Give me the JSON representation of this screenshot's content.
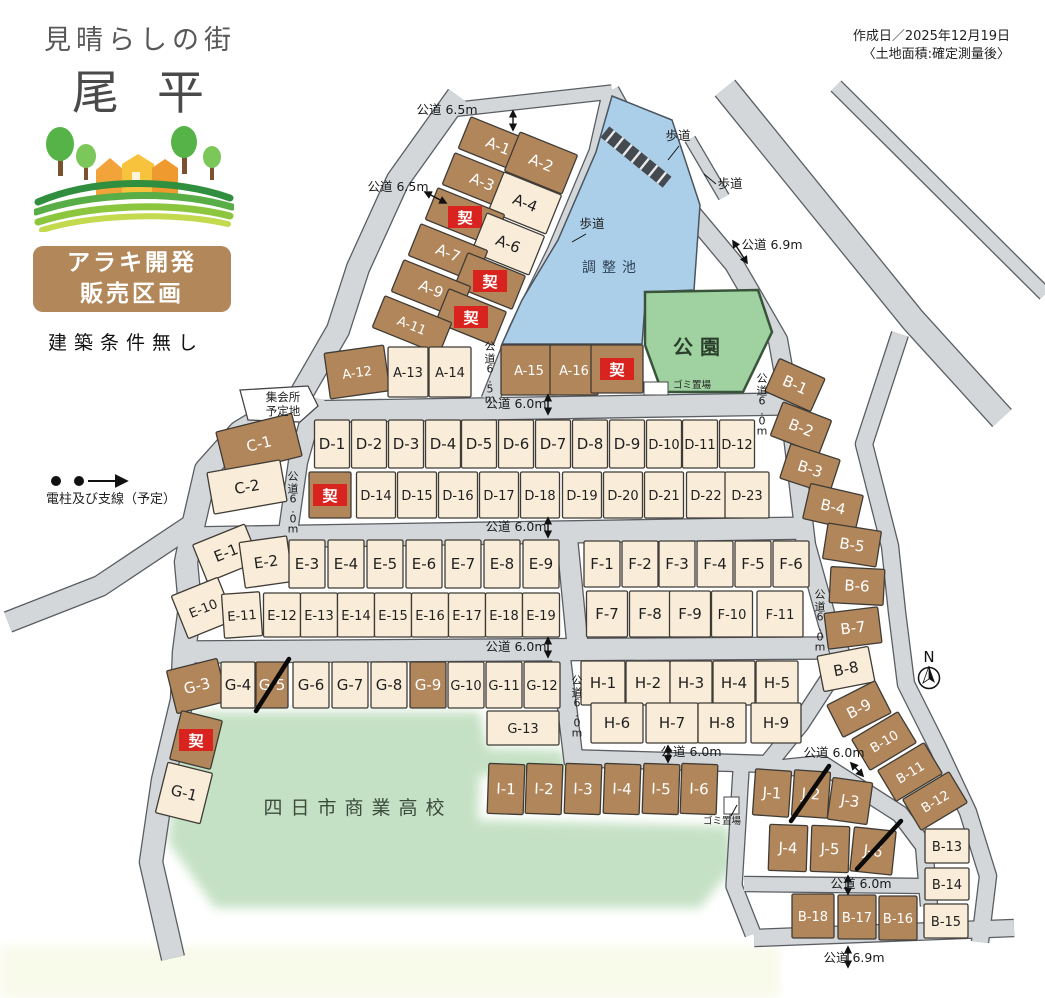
{
  "header": {
    "tagline": "見晴らしの街",
    "name": "尾平",
    "badge_line1": "アラキ開発",
    "badge_line2": "販売区画",
    "condition": "建築条件無し",
    "created": "作成日／2025年12月19日",
    "note": "〈土地面積:確定測量後〉"
  },
  "legend": {
    "utility_label": "電柱及び支線（予定）"
  },
  "compass": "N",
  "contract_mark": "契",
  "colors": {
    "brown": "#b2865b",
    "cream": "#f9ecd9",
    "road": "#d3d7da",
    "road_edge": "#5a5e63",
    "pond": "#accfe9",
    "park": "#9fd2a0",
    "school": "#c2e0c2",
    "red": "#d8231f",
    "outline": "#3f3b35",
    "text_dark": "#1f1f1f",
    "text_light": "#ffffff"
  },
  "areas": {
    "pond": "調整池",
    "park": "公園",
    "school": "四日市商業高校",
    "hall_line1": "集会所",
    "hall_line2": "予定地",
    "trash": "ゴミ置場"
  },
  "lots": [
    [
      "A-1",
      498,
      146,
      72,
      34,
      22,
      "b",
      ""
    ],
    [
      "A-2",
      541,
      163,
      62,
      42,
      22,
      "b",
      ""
    ],
    [
      "A-3",
      482,
      182,
      72,
      34,
      22,
      "b",
      ""
    ],
    [
      "A-4",
      525,
      203,
      62,
      42,
      22,
      "c",
      ""
    ],
    [
      "",
      465,
      217,
      72,
      34,
      22,
      "b",
      "k"
    ],
    [
      "A-6",
      508,
      244,
      62,
      42,
      22,
      "c",
      ""
    ],
    [
      "A-7",
      448,
      253,
      72,
      34,
      22,
      "b",
      ""
    ],
    [
      "",
      490,
      281,
      62,
      36,
      22,
      "b",
      "k"
    ],
    [
      "A-9",
      431,
      289,
      72,
      34,
      22,
      "b",
      ""
    ],
    [
      "",
      471,
      317,
      62,
      36,
      22,
      "b",
      "k"
    ],
    [
      "A-11",
      412,
      325,
      72,
      34,
      22,
      "b",
      ""
    ],
    [
      "A-12",
      357,
      372,
      60,
      46,
      -8,
      "b",
      ""
    ],
    [
      "A-13",
      408,
      372,
      40,
      50,
      0,
      "c",
      ""
    ],
    [
      "A-14",
      450,
      372,
      42,
      50,
      0,
      "c",
      ""
    ],
    [
      "A-15",
      529,
      370,
      56,
      50,
      0,
      "b",
      ""
    ],
    [
      "A-16",
      574,
      370,
      48,
      50,
      0,
      "b",
      ""
    ],
    [
      "",
      617,
      369,
      52,
      48,
      0,
      "b",
      "k"
    ],
    [
      "C-1",
      259,
      444,
      78,
      44,
      -14,
      "b",
      ""
    ],
    [
      "C-2",
      247,
      487,
      74,
      42,
      -10,
      "c",
      ""
    ],
    [
      "D-1",
      332,
      444,
      35,
      48,
      0,
      "c",
      ""
    ],
    [
      "D-2",
      369,
      444,
      35,
      48,
      0,
      "c",
      ""
    ],
    [
      "D-3",
      406,
      444,
      35,
      48,
      0,
      "c",
      ""
    ],
    [
      "D-4",
      443,
      444,
      35,
      48,
      0,
      "c",
      ""
    ],
    [
      "D-5",
      479,
      444,
      35,
      48,
      0,
      "c",
      ""
    ],
    [
      "D-6",
      516,
      444,
      35,
      48,
      0,
      "c",
      ""
    ],
    [
      "D-7",
      553,
      444,
      35,
      48,
      0,
      "c",
      ""
    ],
    [
      "D-8",
      590,
      444,
      35,
      48,
      0,
      "c",
      ""
    ],
    [
      "D-9",
      627,
      444,
      35,
      48,
      0,
      "c",
      ""
    ],
    [
      "D-10",
      664,
      444,
      35,
      48,
      0,
      "c",
      ""
    ],
    [
      "D-11",
      700,
      444,
      35,
      48,
      0,
      "c",
      ""
    ],
    [
      "D-12",
      737,
      444,
      35,
      48,
      0,
      "c",
      ""
    ],
    [
      "",
      330,
      495,
      42,
      46,
      0,
      "b",
      "k"
    ],
    [
      "D-14",
      376,
      495,
      39,
      46,
      0,
      "c",
      ""
    ],
    [
      "D-15",
      417,
      495,
      39,
      46,
      0,
      "c",
      ""
    ],
    [
      "D-16",
      458,
      495,
      39,
      46,
      0,
      "c",
      ""
    ],
    [
      "D-17",
      499,
      495,
      39,
      46,
      0,
      "c",
      ""
    ],
    [
      "D-18",
      540,
      495,
      39,
      46,
      0,
      "c",
      ""
    ],
    [
      "D-19",
      582,
      495,
      39,
      46,
      0,
      "c",
      ""
    ],
    [
      "D-20",
      623,
      495,
      39,
      46,
      0,
      "c",
      ""
    ],
    [
      "D-21",
      664,
      495,
      39,
      46,
      0,
      "c",
      ""
    ],
    [
      "D-22",
      706,
      495,
      39,
      46,
      0,
      "c",
      ""
    ],
    [
      "D-23",
      747,
      495,
      44,
      46,
      0,
      "c",
      ""
    ],
    [
      "E-1",
      226,
      553,
      56,
      40,
      -22,
      "c",
      ""
    ],
    [
      "E-2",
      266,
      562,
      48,
      46,
      -8,
      "c",
      ""
    ],
    [
      "E-3",
      307,
      564,
      36,
      48,
      0,
      "c",
      ""
    ],
    [
      "E-4",
      346,
      564,
      36,
      48,
      0,
      "c",
      ""
    ],
    [
      "E-5",
      385,
      564,
      36,
      48,
      0,
      "c",
      ""
    ],
    [
      "E-6",
      424,
      564,
      36,
      48,
      0,
      "c",
      ""
    ],
    [
      "E-7",
      463,
      564,
      36,
      48,
      0,
      "c",
      ""
    ],
    [
      "E-8",
      502,
      564,
      36,
      48,
      0,
      "c",
      ""
    ],
    [
      "E-9",
      541,
      564,
      36,
      48,
      0,
      "c",
      ""
    ],
    [
      "E-10",
      203,
      608,
      50,
      46,
      -22,
      "c",
      ""
    ],
    [
      "E-11",
      242,
      615,
      38,
      44,
      -4,
      "c",
      ""
    ],
    [
      "E-12",
      282,
      615,
      37,
      44,
      0,
      "c",
      ""
    ],
    [
      "E-13",
      319,
      615,
      37,
      44,
      0,
      "c",
      ""
    ],
    [
      "E-14",
      356,
      615,
      37,
      44,
      0,
      "c",
      ""
    ],
    [
      "E-15",
      393,
      615,
      37,
      44,
      0,
      "c",
      ""
    ],
    [
      "E-16",
      430,
      615,
      37,
      44,
      0,
      "c",
      ""
    ],
    [
      "E-17",
      467,
      615,
      37,
      44,
      0,
      "c",
      ""
    ],
    [
      "E-18",
      504,
      615,
      37,
      44,
      0,
      "c",
      ""
    ],
    [
      "E-19",
      541,
      615,
      37,
      44,
      0,
      "c",
      ""
    ],
    [
      "F-1",
      602,
      564,
      36,
      46,
      0,
      "c",
      ""
    ],
    [
      "F-2",
      640,
      564,
      36,
      46,
      0,
      "c",
      ""
    ],
    [
      "F-3",
      677,
      564,
      36,
      46,
      0,
      "c",
      ""
    ],
    [
      "F-4",
      715,
      564,
      36,
      46,
      0,
      "c",
      ""
    ],
    [
      "F-5",
      753,
      564,
      36,
      46,
      0,
      "c",
      ""
    ],
    [
      "F-6",
      791,
      564,
      36,
      46,
      0,
      "c",
      ""
    ],
    [
      "F-7",
      607,
      614,
      41,
      46,
      0,
      "c",
      ""
    ],
    [
      "F-8",
      650,
      614,
      41,
      46,
      0,
      "c",
      ""
    ],
    [
      "F-9",
      690,
      614,
      41,
      46,
      0,
      "c",
      ""
    ],
    [
      "F-10",
      732,
      614,
      41,
      46,
      0,
      "c",
      ""
    ],
    [
      "F-11",
      780,
      614,
      46,
      46,
      0,
      "c",
      ""
    ],
    [
      "G-3",
      197,
      686,
      52,
      44,
      -14,
      "b",
      ""
    ],
    [
      "G-4",
      238,
      685,
      34,
      46,
      0,
      "c",
      ""
    ],
    [
      "G-5",
      272,
      685,
      32,
      46,
      0,
      "b",
      "s"
    ],
    [
      "G-6",
      311,
      685,
      36,
      46,
      0,
      "c",
      ""
    ],
    [
      "G-7",
      350,
      685,
      36,
      46,
      0,
      "c",
      ""
    ],
    [
      "G-8",
      389,
      685,
      36,
      46,
      0,
      "c",
      ""
    ],
    [
      "G-9",
      428,
      685,
      36,
      46,
      0,
      "b",
      ""
    ],
    [
      "G-10",
      466,
      685,
      36,
      46,
      0,
      "c",
      ""
    ],
    [
      "G-11",
      504,
      685,
      36,
      46,
      0,
      "c",
      ""
    ],
    [
      "G-12",
      542,
      685,
      36,
      46,
      0,
      "c",
      ""
    ],
    [
      "G-13",
      523,
      728,
      72,
      34,
      0,
      "c",
      ""
    ],
    [
      "",
      196,
      740,
      42,
      50,
      14,
      "b",
      "k"
    ],
    [
      "G-1",
      184,
      793,
      46,
      52,
      14,
      "c",
      ""
    ],
    [
      "H-1",
      603,
      683,
      44,
      44,
      0,
      "c",
      ""
    ],
    [
      "H-2",
      648,
      683,
      44,
      44,
      0,
      "c",
      ""
    ],
    [
      "H-3",
      691,
      683,
      42,
      44,
      0,
      "c",
      ""
    ],
    [
      "H-4",
      734,
      683,
      42,
      44,
      0,
      "c",
      ""
    ],
    [
      "H-5",
      777,
      683,
      42,
      44,
      0,
      "c",
      ""
    ],
    [
      "H-6",
      617,
      723,
      52,
      40,
      0,
      "c",
      ""
    ],
    [
      "H-7",
      672,
      723,
      52,
      40,
      0,
      "c",
      ""
    ],
    [
      "H-8",
      722,
      723,
      48,
      40,
      0,
      "c",
      ""
    ],
    [
      "H-9",
      776,
      723,
      50,
      40,
      0,
      "c",
      ""
    ],
    [
      "I-1",
      506,
      789,
      36,
      50,
      2,
      "b",
      ""
    ],
    [
      "I-2",
      544,
      789,
      36,
      50,
      2,
      "b",
      ""
    ],
    [
      "I-3",
      583,
      789,
      36,
      50,
      2,
      "b",
      ""
    ],
    [
      "I-4",
      622,
      789,
      36,
      50,
      2,
      "b",
      ""
    ],
    [
      "I-5",
      661,
      789,
      36,
      50,
      2,
      "b",
      ""
    ],
    [
      "I-6",
      699,
      789,
      36,
      50,
      2,
      "b",
      ""
    ],
    [
      "J-1",
      772,
      793,
      36,
      46,
      4,
      "b",
      ""
    ],
    [
      "J-2",
      811,
      794,
      36,
      46,
      4,
      "b",
      "s"
    ],
    [
      "J-3",
      850,
      801,
      40,
      42,
      8,
      "b",
      ""
    ],
    [
      "J-4",
      788,
      848,
      38,
      46,
      2,
      "b",
      ""
    ],
    [
      "J-5",
      830,
      849,
      38,
      46,
      2,
      "b",
      ""
    ],
    [
      "J-6",
      873,
      851,
      42,
      44,
      6,
      "b",
      "s"
    ],
    [
      "B-1",
      795,
      385,
      50,
      36,
      24,
      "b",
      ""
    ],
    [
      "B-2",
      801,
      428,
      52,
      36,
      21,
      "b",
      ""
    ],
    [
      "B-3",
      810,
      469,
      52,
      36,
      18,
      "b",
      ""
    ],
    [
      "B-4",
      833,
      507,
      54,
      36,
      13,
      "b",
      ""
    ],
    [
      "B-5",
      852,
      545,
      54,
      36,
      9,
      "b",
      ""
    ],
    [
      "B-6",
      857,
      586,
      54,
      36,
      3,
      "b",
      ""
    ],
    [
      "B-7",
      853,
      628,
      54,
      36,
      -7,
      "b",
      ""
    ],
    [
      "B-8",
      846,
      669,
      52,
      36,
      -11,
      "c",
      ""
    ],
    [
      "B-9",
      859,
      709,
      54,
      36,
      -27,
      "b",
      ""
    ],
    [
      "B-10",
      884,
      741,
      54,
      36,
      -31,
      "b",
      ""
    ],
    [
      "B-11",
      910,
      772,
      54,
      36,
      -31,
      "b",
      ""
    ],
    [
      "B-12",
      935,
      801,
      54,
      36,
      -31,
      "b",
      ""
    ],
    [
      "B-13",
      947,
      846,
      44,
      34,
      0,
      "c",
      ""
    ],
    [
      "B-14",
      947,
      884,
      44,
      32,
      0,
      "c",
      ""
    ],
    [
      "B-15",
      946,
      921,
      44,
      34,
      0,
      "c",
      ""
    ],
    [
      "B-16",
      898,
      918,
      38,
      44,
      0,
      "b",
      ""
    ],
    [
      "B-17",
      857,
      917,
      38,
      44,
      0,
      "b",
      ""
    ],
    [
      "B-18",
      813,
      916,
      42,
      44,
      0,
      "b",
      ""
    ]
  ],
  "road_labels": [
    [
      "公道 6.5m",
      447,
      114,
      0
    ],
    [
      "公道 6.5m",
      398,
      191,
      0
    ],
    [
      "歩道",
      678,
      140,
      0
    ],
    [
      "歩道",
      730,
      188,
      0
    ],
    [
      "歩道",
      592,
      228,
      0
    ],
    [
      "公道 6.9m",
      772,
      249,
      0
    ],
    [
      "公道6.5m",
      490,
      350,
      1
    ],
    [
      "公道 6.0m",
      516,
      408,
      0
    ],
    [
      "公道6.0m",
      762,
      382,
      1
    ],
    [
      "公道6.0m",
      293,
      480,
      1
    ],
    [
      "公道 6.0m",
      516,
      531,
      0
    ],
    [
      "公道6.0m",
      820,
      598,
      1
    ],
    [
      "公道 6.0m",
      516,
      651,
      0
    ],
    [
      "公道6.0m",
      577,
      684,
      1
    ],
    [
      "公道 6.0m",
      691,
      756,
      0
    ],
    [
      "公道 6.0m",
      834,
      757,
      0
    ],
    [
      "公道 6.0m",
      861,
      888,
      0
    ],
    [
      "公道 6.9m",
      854,
      962,
      0
    ]
  ],
  "area_labels": [
    [
      "調整池",
      612,
      272,
      14,
      6,
      "#2e4257",
      0
    ],
    [
      "公園",
      700,
      354,
      20,
      7,
      "#2c3e2c",
      1
    ],
    [
      "四日市商業高校",
      358,
      814,
      19,
      8,
      "#3c4c3c",
      0
    ],
    [
      "ゴミ置場",
      692,
      388,
      9.5,
      0,
      "#222222",
      0
    ],
    [
      "ゴミ置場",
      722,
      824,
      9.5,
      0,
      "#222222",
      0
    ],
    [
      "集会所",
      283,
      401,
      11.5,
      0,
      "#222222",
      0
    ],
    [
      "予定地",
      283,
      415,
      11.5,
      0,
      "#222222",
      0
    ]
  ],
  "slashes": [
    [
      289,
      659,
      256,
      711
    ],
    [
      829,
      766,
      791,
      821
    ],
    [
      901,
      821,
      857,
      869
    ]
  ],
  "arrows": [
    [
      513,
      111,
      513,
      130
    ],
    [
      425,
      192,
      446,
      203
    ],
    [
      548,
      395,
      548,
      414
    ],
    [
      548,
      518,
      548,
      537
    ],
    [
      548,
      638,
      548,
      657
    ],
    [
      668,
      746,
      668,
      762
    ],
    [
      733,
      241,
      747,
      263
    ],
    [
      851,
      763,
      863,
      776
    ],
    [
      848,
      876,
      848,
      894
    ],
    [
      848,
      947,
      848,
      967
    ]
  ],
  "leaders": [
    [
      679,
      146,
      668,
      160
    ],
    [
      716,
      184,
      704,
      174
    ],
    [
      586,
      234,
      572,
      242
    ],
    [
      731,
      816,
      737,
      805
    ]
  ]
}
